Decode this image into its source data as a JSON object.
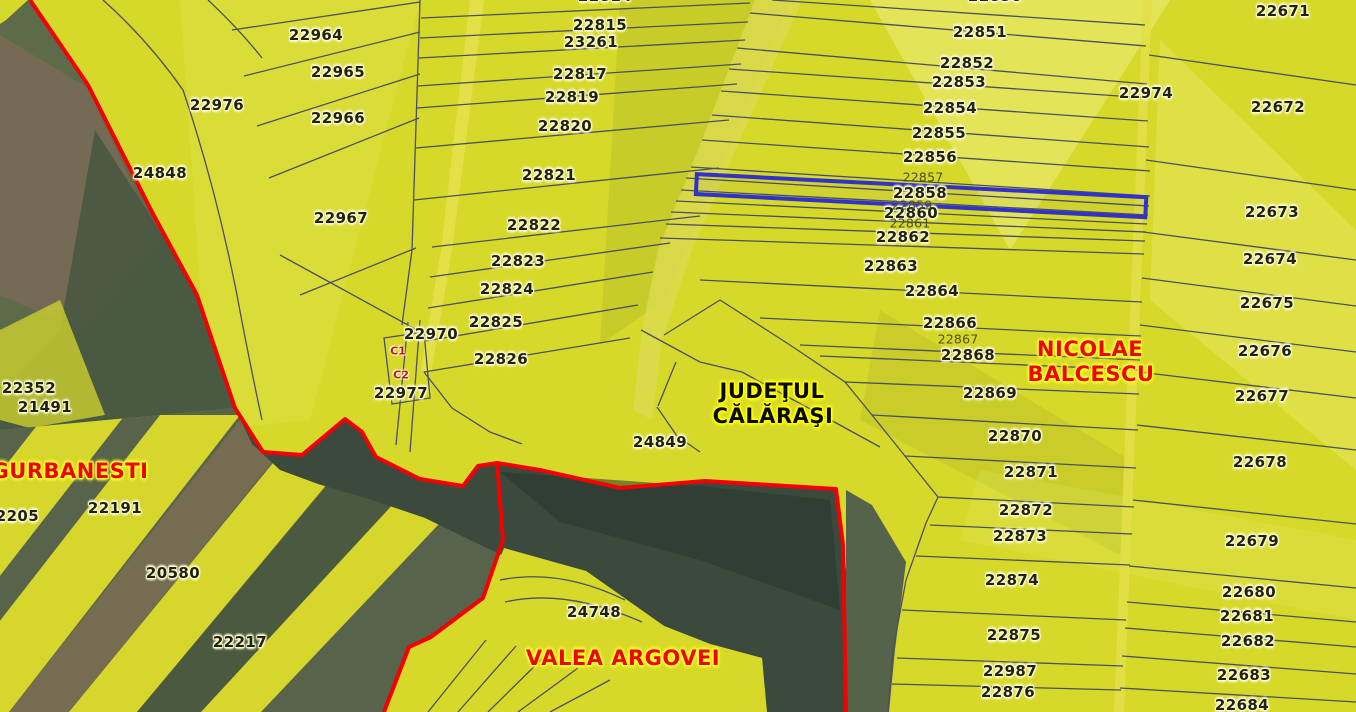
{
  "map": {
    "region_names": {
      "county": "JUDEŢUL CĂLĂRAŞI",
      "communes": [
        "GURBANESTI",
        "NICOLAE BALCESCU",
        "VALEA ARGOVEI"
      ]
    },
    "selection": {
      "highlighted_parcel": "22858",
      "highlight_color": "#3231c8"
    },
    "colors": {
      "field_yellow": "#d7d92a",
      "road_yellow": "#e3e04a",
      "water_dark": "#3c4a3d",
      "imagery_green": "#5e6b4a",
      "imagery_brown": "#776d52",
      "boundary_red": "#f40000",
      "parcel_line": "#4b5060",
      "label_halo": "#fcfad2"
    },
    "county_labels": [
      {
        "t": "JUDEŢUL",
        "x": 772,
        "y": 391
      },
      {
        "t": "CĂLĂRAŞI",
        "x": 773,
        "y": 416
      }
    ],
    "place_labels": [
      {
        "t": "GURBANESTI",
        "x": 70,
        "y": 471
      },
      {
        "t": "NICOLAE",
        "x": 1090,
        "y": 349
      },
      {
        "t": "BALCESCU",
        "x": 1091,
        "y": 374
      },
      {
        "t": "VALEA ARGOVEI",
        "x": 623,
        "y": 658
      }
    ],
    "parcel_labels": [
      {
        "t": "22964",
        "x": 316,
        "y": 35
      },
      {
        "t": "22965",
        "x": 338,
        "y": 72
      },
      {
        "t": "22966",
        "x": 338,
        "y": 118
      },
      {
        "t": "22967",
        "x": 341,
        "y": 218
      },
      {
        "t": "22976",
        "x": 217,
        "y": 105
      },
      {
        "t": "24848",
        "x": 160,
        "y": 173
      },
      {
        "t": "22352",
        "x": 29,
        "y": 388
      },
      {
        "t": "21491",
        "x": 45,
        "y": 407
      },
      {
        "t": "22191",
        "x": 115,
        "y": 508
      },
      {
        "t": "20580",
        "x": 173,
        "y": 573
      },
      {
        "t": "22217",
        "x": 240,
        "y": 642
      },
      {
        "t": "22970",
        "x": 431,
        "y": 334
      },
      {
        "t": "22977",
        "x": 401,
        "y": 393
      },
      {
        "t": "22815",
        "x": 600,
        "y": 25
      },
      {
        "t": "23261",
        "x": 591,
        "y": 42
      },
      {
        "t": "22817",
        "x": 580,
        "y": 74
      },
      {
        "t": "22819",
        "x": 572,
        "y": 97
      },
      {
        "t": "22820",
        "x": 565,
        "y": 126
      },
      {
        "t": "22821",
        "x": 549,
        "y": 175
      },
      {
        "t": "22822",
        "x": 534,
        "y": 225
      },
      {
        "t": "22823",
        "x": 518,
        "y": 261
      },
      {
        "t": "22824",
        "x": 507,
        "y": 289
      },
      {
        "t": "22825",
        "x": 496,
        "y": 322
      },
      {
        "t": "22826",
        "x": 501,
        "y": 359
      },
      {
        "t": "24849",
        "x": 660,
        "y": 442
      },
      {
        "t": "24748",
        "x": 594,
        "y": 612
      },
      {
        "t": "22851",
        "x": 980,
        "y": 32
      },
      {
        "t": "22852",
        "x": 967,
        "y": 63
      },
      {
        "t": "22853",
        "x": 959,
        "y": 82
      },
      {
        "t": "22854",
        "x": 950,
        "y": 108
      },
      {
        "t": "22855",
        "x": 939,
        "y": 133
      },
      {
        "t": "22856",
        "x": 930,
        "y": 157
      },
      {
        "t": "22858",
        "x": 920,
        "y": 193
      },
      {
        "t": "22860",
        "x": 911,
        "y": 213
      },
      {
        "t": "22862",
        "x": 903,
        "y": 237
      },
      {
        "t": "22863",
        "x": 891,
        "y": 266
      },
      {
        "t": "22864",
        "x": 932,
        "y": 291
      },
      {
        "t": "22866",
        "x": 950,
        "y": 323
      },
      {
        "t": "22868",
        "x": 968,
        "y": 355
      },
      {
        "t": "22869",
        "x": 990,
        "y": 393
      },
      {
        "t": "22870",
        "x": 1015,
        "y": 436
      },
      {
        "t": "22871",
        "x": 1031,
        "y": 472
      },
      {
        "t": "22872",
        "x": 1026,
        "y": 510
      },
      {
        "t": "22873",
        "x": 1020,
        "y": 536
      },
      {
        "t": "22874",
        "x": 1012,
        "y": 580
      },
      {
        "t": "22875",
        "x": 1014,
        "y": 635
      },
      {
        "t": "22987",
        "x": 1010,
        "y": 671
      },
      {
        "t": "22876",
        "x": 1008,
        "y": 692
      },
      {
        "t": "22974",
        "x": 1146,
        "y": 93
      },
      {
        "t": "22671",
        "x": 1283,
        "y": 11
      },
      {
        "t": "22672",
        "x": 1278,
        "y": 107
      },
      {
        "t": "22673",
        "x": 1272,
        "y": 212
      },
      {
        "t": "22674",
        "x": 1270,
        "y": 259
      },
      {
        "t": "22675",
        "x": 1267,
        "y": 303
      },
      {
        "t": "22676",
        "x": 1265,
        "y": 351
      },
      {
        "t": "22677",
        "x": 1262,
        "y": 396
      },
      {
        "t": "22678",
        "x": 1260,
        "y": 462
      },
      {
        "t": "22679",
        "x": 1252,
        "y": 541
      },
      {
        "t": "22680",
        "x": 1249,
        "y": 592
      },
      {
        "t": "22681",
        "x": 1247,
        "y": 616
      },
      {
        "t": "22682",
        "x": 1248,
        "y": 641
      },
      {
        "t": "22683",
        "x": 1244,
        "y": 675
      },
      {
        "t": "22684",
        "x": 1242,
        "y": 705
      }
    ],
    "small_labels": [
      {
        "t": "22857",
        "x": 923,
        "y": 177
      },
      {
        "t": "22859",
        "x": 912,
        "y": 205
      },
      {
        "t": "22861",
        "x": 910,
        "y": 223
      },
      {
        "t": "22867",
        "x": 958,
        "y": 339
      }
    ],
    "partial_labels": [
      {
        "t": "22814",
        "x": 605,
        "y": -4
      },
      {
        "t": "22850",
        "x": 995,
        "y": -4
      },
      {
        "t": "22205",
        "x": 12,
        "y": 516
      }
    ],
    "building_markers": [
      {
        "t": "C1",
        "x": 398,
        "y": 351
      },
      {
        "t": "C2",
        "x": 401,
        "y": 375
      }
    ]
  }
}
